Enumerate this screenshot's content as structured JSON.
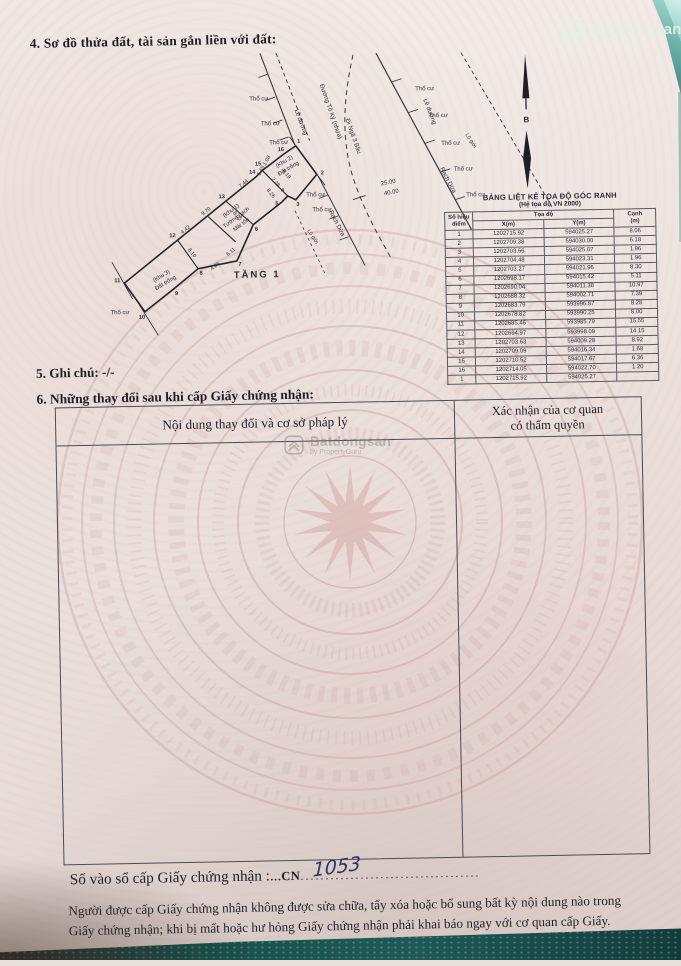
{
  "section4": {
    "title": "4. Sơ đồ thửa đất, tài sản gắn liền với đất:"
  },
  "section5": {
    "text": "5. Ghi chú: -/-"
  },
  "section6": {
    "title": "6. Những thay đổi sau khi cấp Giấy chứng nhận:",
    "col1": "Nội dung thay đổi và cơ sở pháp lý",
    "col2_line1": "Xác nhận của cơ quan",
    "col2_line2": "có thẩm quyền"
  },
  "registry": {
    "label": "Số vào sổ cấp Giấy chứng nhận :...",
    "prefix": "CN",
    "dots": "....................................",
    "number": "1053"
  },
  "footer": {
    "text": "Người được cấp Giấy chứng nhận không được sửa chữa, tẩy xóa hoặc bổ sung bất kỳ nội dung nào trong Giấy chứng nhận; khi bị mất hoặc hư hỏng Giấy chứng nhận phải khai báo ngay với cơ quan cấp Giấy."
  },
  "watermark": {
    "brand": "Batdongsan",
    "byline": "by PropertyGuru"
  },
  "coord_table": {
    "title": "BẢNG LIỆT KÊ TỌA ĐỘ GÓC RANH",
    "subtitle": "(Hệ tọa độ VN 2000)",
    "col_point_1": "Số hiệu",
    "col_point_2": "điểm",
    "col_coord": "Tọa độ",
    "col_x": "X(m)",
    "col_y": "Y(m)",
    "col_edge_1": "Cạnh",
    "col_edge_2": "(m)",
    "rows": [
      [
        "1",
        "1202715.92",
        "594025.27",
        "8.06"
      ],
      [
        "2",
        "1202709.38",
        "594030.00",
        "6.18"
      ],
      [
        "3",
        "1202703.66",
        "594025.07",
        "1.96"
      ],
      [
        "4",
        "1202704.48",
        "594023.31",
        "1.96"
      ],
      [
        "5",
        "1202703.27",
        "594021.96",
        "8.30"
      ],
      [
        "6",
        "1202698.17",
        "594015.42",
        "5.11"
      ],
      [
        "7",
        "1202690.04",
        "594011.38",
        "10.97"
      ],
      [
        "8",
        "1202688.32",
        "594002.71",
        "7.39"
      ],
      [
        "9",
        "1202683.79",
        "593996.87",
        "8.28"
      ],
      [
        "10",
        "1202678.82",
        "593990.25",
        "8.00"
      ],
      [
        "11",
        "1202685.46",
        "593985.79",
        "15.55"
      ],
      [
        "12",
        "1202694.97",
        "593998.09",
        "14.15"
      ],
      [
        "13",
        "1202703.63",
        "594009.28",
        "8.92"
      ],
      [
        "14",
        "1202709.09",
        "594016.34",
        "1.68"
      ],
      [
        "15",
        "1202710.52",
        "594017.67",
        "6.36"
      ],
      [
        "16",
        "1202714.05",
        "594022.70",
        "1.20"
      ],
      [
        "1",
        "1202715.92",
        "594025.27",
        ""
      ]
    ]
  },
  "diagram": {
    "tho_cu": {
      "label": "Thổ cư",
      "positions": [
        {
          "x": 238,
          "y": 47
        },
        {
          "x": 249,
          "y": 72
        },
        {
          "x": 257,
          "y": 91
        },
        {
          "x": 404,
          "y": 40
        },
        {
          "x": 417,
          "y": 67
        },
        {
          "x": 429,
          "y": 95
        },
        {
          "x": 441,
          "y": 121
        },
        {
          "x": 453,
          "y": 147
        },
        {
          "x": 293,
          "y": 144
        },
        {
          "x": 299,
          "y": 159
        },
        {
          "x": 95,
          "y": 258
        }
      ]
    },
    "points": [
      {
        "t": "1",
        "x": 277,
        "y": 90
      },
      {
        "t": "2",
        "x": 300,
        "y": 122
      },
      {
        "t": "3",
        "x": 275,
        "y": 153
      },
      {
        "t": "4",
        "x": 260,
        "y": 139
      },
      {
        "t": "5",
        "x": 254,
        "y": 152
      },
      {
        "t": "6",
        "x": 233,
        "y": 177
      },
      {
        "t": "7",
        "x": 216,
        "y": 212
      },
      {
        "t": "8",
        "x": 177,
        "y": 220
      },
      {
        "t": "9",
        "x": 152,
        "y": 240
      },
      {
        "t": "10",
        "x": 117,
        "y": 263
      },
      {
        "t": "11",
        "x": 93,
        "y": 226
      },
      {
        "t": "12",
        "x": 149,
        "y": 182
      },
      {
        "t": "13",
        "x": 199,
        "y": 144
      },
      {
        "t": "14",
        "x": 230,
        "y": 120
      },
      {
        "t": "15",
        "x": 236,
        "y": 112
      },
      {
        "t": "16",
        "x": 259,
        "y": 98
      }
    ],
    "dims": [
      {
        "t": "4.42",
        "x": 163,
        "y": 176,
        "r": -37
      },
      {
        "t": "9.70",
        "x": 184,
        "y": 158,
        "r": -37
      },
      {
        "t": "7.44",
        "x": 222,
        "y": 131,
        "r": -37
      },
      {
        "t": "1.45",
        "x": 240,
        "y": 118,
        "r": -60
      },
      {
        "t": "1.08",
        "x": 246,
        "y": 108,
        "r": -60
      },
      {
        "t": "6.19",
        "x": 263,
        "y": 122,
        "r": 52
      },
      {
        "t": "2.28",
        "x": 252,
        "y": 130,
        "r": 52
      },
      {
        "t": "8.26",
        "x": 247,
        "y": 141,
        "r": 52
      },
      {
        "t": "8.05",
        "x": 213,
        "y": 163,
        "r": 52
      },
      {
        "t": "8.10",
        "x": 167,
        "y": 199,
        "r": 52
      },
      {
        "t": "4.06",
        "x": 192,
        "y": 213,
        "r": -37
      },
      {
        "t": "6.11",
        "x": 208,
        "y": 199,
        "r": -37
      }
    ],
    "labels": [
      {
        "t": "(Khu 1)",
        "x": 209,
        "y": 158,
        "r": -36,
        "c": "zone"
      },
      {
        "t": "Tường gạch",
        "x": 214,
        "y": 165,
        "r": -36,
        "c": "zone"
      },
      {
        "t": "Mái tôn",
        "x": 219,
        "y": 172,
        "r": -36,
        "c": "zone"
      },
      {
        "t": "(Khu 2)",
        "x": 263,
        "y": 110,
        "r": -30,
        "c": "zone"
      },
      {
        "t": "Đất trống",
        "x": 267,
        "y": 117,
        "r": -30,
        "c": "zone"
      },
      {
        "t": "(Khu 3)",
        "x": 138,
        "y": 222,
        "r": -30,
        "c": "zone"
      },
      {
        "t": "Đất trống",
        "x": 142,
        "y": 229,
        "r": -30,
        "c": "zone"
      },
      {
        "t": "Lề đường",
        "x": 278,
        "y": 70,
        "r": 70,
        "c": "rd"
      },
      {
        "t": "Lề đường",
        "x": 407,
        "y": 62,
        "r": 70,
        "c": "rd"
      },
      {
        "t": "Đường Tô Ký (nhựa)",
        "x": 308,
        "y": 60,
        "r": 72,
        "c": "rd"
      },
      {
        "t": "Đi Ngã 3 Bầu",
        "x": 330,
        "y": 85,
        "r": 72,
        "c": "rd"
      },
      {
        "t": "Rạch Dừa",
        "x": 312,
        "y": 172,
        "r": 64,
        "c": "rd"
      },
      {
        "t": "Rạch Dừa",
        "x": 424,
        "y": 131,
        "r": 64,
        "c": "rd"
      },
      {
        "t": "Lộ giới",
        "x": 288,
        "y": 185,
        "r": 58,
        "c": "sm"
      },
      {
        "t": "Lộ giới",
        "x": 448,
        "y": 92,
        "r": 58,
        "c": "sm"
      },
      {
        "t": "TẦNG 1",
        "x": 233,
        "y": 224,
        "r": 0,
        "c": "floor"
      },
      {
        "t": "B",
        "x": 505,
        "y": 74,
        "r": 0,
        "c": "north"
      },
      {
        "t": "25.00",
        "x": 366,
        "y": 133,
        "r": -10,
        "c": "dim2"
      },
      {
        "t": "40.00",
        "x": 369,
        "y": 143,
        "r": -10,
        "c": "dim2"
      }
    ]
  }
}
